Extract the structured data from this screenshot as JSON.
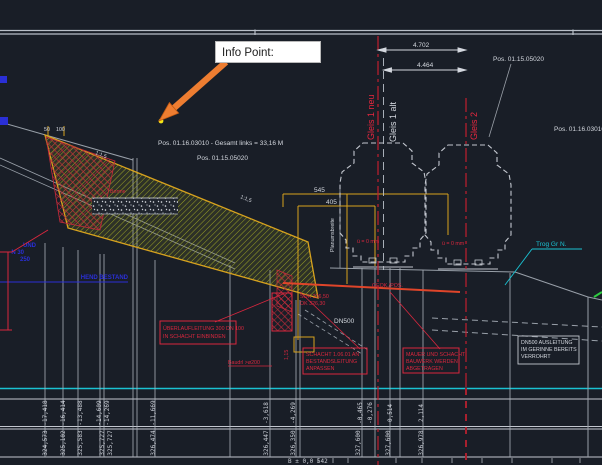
{
  "callout": {
    "info_label": "Info Point:"
  },
  "pos": {
    "top_right": "Pos. 01.15.05020",
    "gesamt": "Pos. 01.16.03010 - Gesamt links = 33,16 M",
    "mid": "Pos. 01.15.05020",
    "right_edge": "Pos. 01.16.03010 -"
  },
  "dims": {
    "d4702": "4.702",
    "d4464": "4.464",
    "d545": "545",
    "d405": "405",
    "d50": "50",
    "d100": "100",
    "d115": "1,15"
  },
  "tracks": {
    "g1neu": "Gleis 1 neu",
    "g1alt": "Gleis 1 alt",
    "g2": "Gleis 2",
    "cant1": "ü = 0 mm",
    "cant2": "ü = 0 mm"
  },
  "labels": {
    "trog": "Trog Gr N.",
    "dn500": "DN500",
    "planum": "Planumsbreite",
    "slope1": "1:1,5",
    "slope2": "1:1,5",
    "berme": "Berme",
    "sok1": "SOK 326,50",
    "sok2": "OK 326,30",
    "pipe": "GEOK./POS.",
    "baudrl": "Baudrl >ø200",
    "micro": "B ± 0,0 542",
    "blue1": "UND",
    "blue2": "N 30",
    "blue3": "250",
    "blue4": "HEND BESTAND"
  },
  "boxes": {
    "ueberlauf1": "ÜBERLAUFLEITUNG 300 DN 100",
    "ueberlauf2": "IN SCHACHT EINBINDEN",
    "schacht1": "SCHACHT 1.06.01 AN",
    "schacht2": "BESTANDSLEITUNG",
    "schacht3": "ANPASSEN",
    "mauer1": "MAUER UND SCHACHT",
    "mauer2": "BAUWERK WERDEN",
    "mauer3": "ABGETRAGEN",
    "dn1": "DN500 AUSLEITUNG",
    "dn2": "IM GERINNE BEREITS",
    "dn3": "VERROHRT"
  },
  "table": {
    "cols": [
      {
        "dist": "-17,418",
        "elev": "324,573"
      },
      {
        "dist": "-16,414",
        "elev": "325,102"
      },
      {
        "dist": "-13,488",
        "elev": "325,583"
      },
      {
        "dist": "-14,609",
        "elev": "325,727"
      },
      {
        "dist": "-14,269",
        "elev": "325,727"
      },
      {
        "dist": "-11,669",
        "elev": "326,474"
      },
      {
        "dist": "-3,618",
        "elev": "326,447"
      },
      {
        "dist": "-4,269",
        "elev": "326,350"
      },
      {
        "dist": "-0,465",
        "elev": "327,600"
      },
      {
        "dist": "-0,276",
        "elev": ""
      },
      {
        "dist": "0,514",
        "elev": "327,600"
      },
      {
        "dist": "2,114",
        "elev": "326,978"
      }
    ]
  },
  "colors": {
    "background": "#191e27",
    "accent_orange": "#ed7d31",
    "cad_yellow": "#d7a21e",
    "cad_red": "#d9273e",
    "centerline_red": "#c01f2e",
    "cad_cyan": "#1ac2d2",
    "cad_blue": "#2a2fd6",
    "line_gray": "#b9bfc8"
  }
}
